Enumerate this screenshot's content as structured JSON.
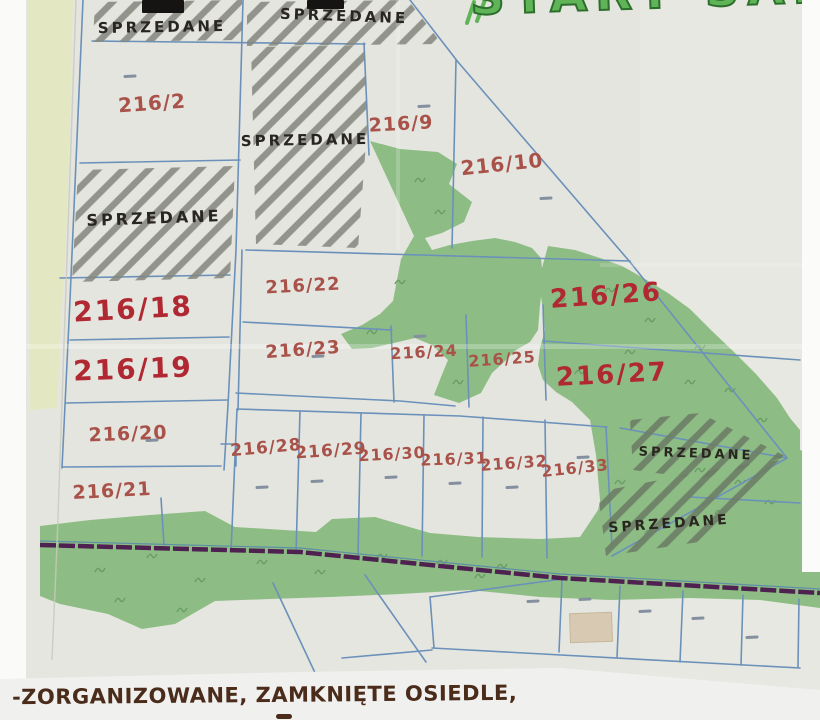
{
  "map": {
    "title_partial": "STARY SAD",
    "sold_label_text": "SPRZEDANE",
    "note_line": "-ZORGANIZOWANE, ZAMKNIĘTE OSIEDLE,",
    "parcel_numbers": [
      "216/2",
      "216/9",
      "216/10",
      "216/18",
      "216/19",
      "216/20",
      "216/21",
      "216/22",
      "216/23",
      "216/24",
      "216/25",
      "216/26",
      "216/27",
      "216/28",
      "216/29",
      "216/30",
      "216/31",
      "216/32",
      "216/33"
    ]
  },
  "colors": {
    "paper": "#e4e5df",
    "green_area": "#8dbd84",
    "tree_mark": "#6b9d66",
    "line_blue": "#6b91ba",
    "label_red": "#a8524a",
    "label_red_bold": "#b02832",
    "hatch_gray": "#83857d",
    "hatch_dark": "#6c7d66",
    "road_purple": "#4e2151",
    "road_teal": "#5e8fa6",
    "yellow_strip": "#e4e8c2",
    "title_green": "#5eb457",
    "note_brown": "#4b2c1b",
    "censor_black": "#161412",
    "building_beige": "#d8cab2"
  },
  "parcels": [
    {
      "num": "216/2",
      "x": 152,
      "y": 103,
      "size": 20,
      "bold": false,
      "rot": -4
    },
    {
      "num": "216/9",
      "x": 401,
      "y": 124,
      "size": 19,
      "bold": false,
      "rot": -3
    },
    {
      "num": "216/10",
      "x": 502,
      "y": 164,
      "size": 20,
      "bold": false,
      "rot": -6
    },
    {
      "num": "216/18",
      "x": 133,
      "y": 309,
      "size": 28,
      "bold": true,
      "rot": -3
    },
    {
      "num": "216/19",
      "x": 133,
      "y": 369,
      "size": 28,
      "bold": true,
      "rot": -2
    },
    {
      "num": "216/20",
      "x": 128,
      "y": 434,
      "size": 19,
      "bold": false,
      "rot": -2
    },
    {
      "num": "216/21",
      "x": 112,
      "y": 491,
      "size": 19,
      "bold": false,
      "rot": -3
    },
    {
      "num": "216/22",
      "x": 303,
      "y": 286,
      "size": 18,
      "bold": false,
      "rot": -3
    },
    {
      "num": "216/23",
      "x": 303,
      "y": 350,
      "size": 18,
      "bold": false,
      "rot": -4
    },
    {
      "num": "216/24",
      "x": 424,
      "y": 352,
      "size": 16,
      "bold": false,
      "rot": -3
    },
    {
      "num": "216/25",
      "x": 502,
      "y": 359,
      "size": 16,
      "bold": false,
      "rot": -4
    },
    {
      "num": "216/26",
      "x": 606,
      "y": 296,
      "size": 26,
      "bold": true,
      "rot": -4
    },
    {
      "num": "216/27",
      "x": 612,
      "y": 375,
      "size": 26,
      "bold": true,
      "rot": -3
    },
    {
      "num": "216/28",
      "x": 266,
      "y": 448,
      "size": 17,
      "bold": false,
      "rot": -5
    },
    {
      "num": "216/29",
      "x": 331,
      "y": 451,
      "size": 17,
      "bold": false,
      "rot": -4
    },
    {
      "num": "216/30",
      "x": 392,
      "y": 454,
      "size": 16,
      "bold": false,
      "rot": -3
    },
    {
      "num": "216/31",
      "x": 454,
      "y": 459,
      "size": 16,
      "bold": false,
      "rot": -2
    },
    {
      "num": "216/32",
      "x": 514,
      "y": 463,
      "size": 16,
      "bold": false,
      "rot": -4
    },
    {
      "num": "216/33",
      "x": 575,
      "y": 468,
      "size": 16,
      "bold": false,
      "rot": -6
    }
  ],
  "sold_markers": [
    {
      "x": 162,
      "y": 27,
      "rot": -1,
      "size": 15
    },
    {
      "x": 344,
      "y": 16,
      "rot": 2,
      "size": 15
    },
    {
      "x": 305,
      "y": 140,
      "rot": -1,
      "size": 15
    },
    {
      "x": 154,
      "y": 218,
      "rot": -2,
      "size": 16
    },
    {
      "x": 696,
      "y": 454,
      "rot": 2,
      "size": 13
    },
    {
      "x": 669,
      "y": 524,
      "rot": -4,
      "size": 14
    }
  ],
  "dash_marks": [
    [
      130,
      76
    ],
    [
      424,
      106
    ],
    [
      546,
      198
    ],
    [
      318,
      356
    ],
    [
      420,
      336
    ],
    [
      152,
      440
    ],
    [
      262,
      487
    ],
    [
      317,
      481
    ],
    [
      391,
      477
    ],
    [
      455,
      483
    ],
    [
      512,
      487
    ],
    [
      583,
      457
    ],
    [
      533,
      601
    ],
    [
      585,
      599
    ],
    [
      645,
      611
    ],
    [
      698,
      618
    ],
    [
      752,
      637
    ]
  ]
}
